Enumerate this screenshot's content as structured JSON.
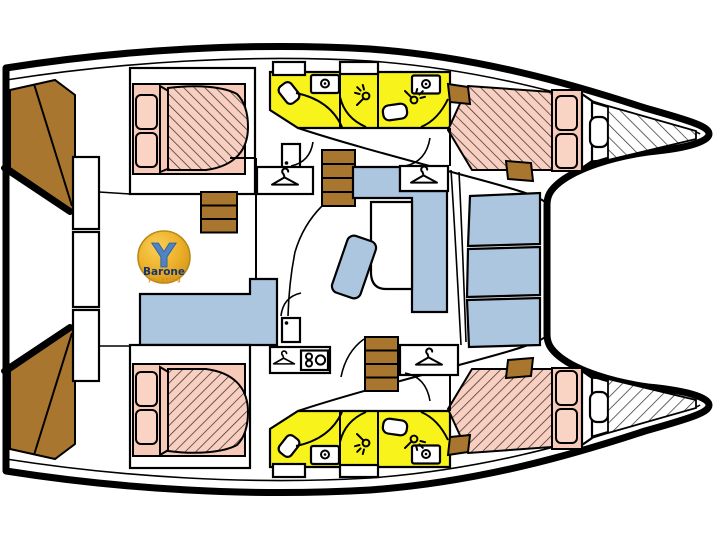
{
  "logo": {
    "initial": "Y",
    "name": "Barone",
    "subtitle": "yachting"
  },
  "colors": {
    "hull_outline": "#000000",
    "deck_white": "#ffffff",
    "bathroom_yellow": "#f7f31b",
    "bed_pink": "#f7c9b8",
    "bed_pink_light": "#f9d3c4",
    "furniture_blue": "#adc6e0",
    "wood_brown": "#a8762e",
    "hatch_line": "#3b332f",
    "logo_gold": "#eeb22c",
    "logo_gold_light": "#f8cf58",
    "logo_gold_dark": "#d3961b",
    "logo_blue": "#4f83c2",
    "logo_text_navy": "#17356d",
    "logo_subtitle_orange": "#e2891c"
  },
  "plan": {
    "vessel_type": "catamaran-deck-plan",
    "orientation": "bow-right",
    "hulls": [
      {
        "side": "port-top",
        "cabins": [
          "aft-double-cabin",
          "forward-double-cabin"
        ],
        "bathrooms": [
          {
            "fixtures": [
              "toilet",
              "sink",
              "shower"
            ]
          },
          {
            "fixtures": [
              "toilet",
              "sink",
              "shower"
            ]
          }
        ],
        "features": [
          "companionway-steps",
          "wardrobe",
          "bow-storage-locker",
          "transom-steps"
        ]
      },
      {
        "side": "starboard-bottom",
        "cabins": [
          "aft-double-cabin",
          "forward-double-cabin"
        ],
        "bathrooms": [
          {
            "fixtures": [
              "toilet",
              "sink",
              "shower"
            ]
          },
          {
            "fixtures": [
              "toilet",
              "sink",
              "shower"
            ]
          }
        ],
        "features": [
          "companionway-steps",
          "wardrobe",
          "bow-storage-locker",
          "transom-steps"
        ]
      }
    ],
    "salon": {
      "furniture": [
        "l-shaped-sofa",
        "table",
        "galley-counter",
        "nav-seat",
        "wardrobes",
        "entry-doors",
        "sink-unit",
        "staircases"
      ]
    },
    "cockpits": {
      "aft": [
        "bench-lockers"
      ],
      "forward": [
        "bench-seats",
        "trampoline-area"
      ]
    }
  },
  "icons": [
    "hanger-icon",
    "shower-head-icon",
    "sink-icon",
    "door-icon"
  ]
}
